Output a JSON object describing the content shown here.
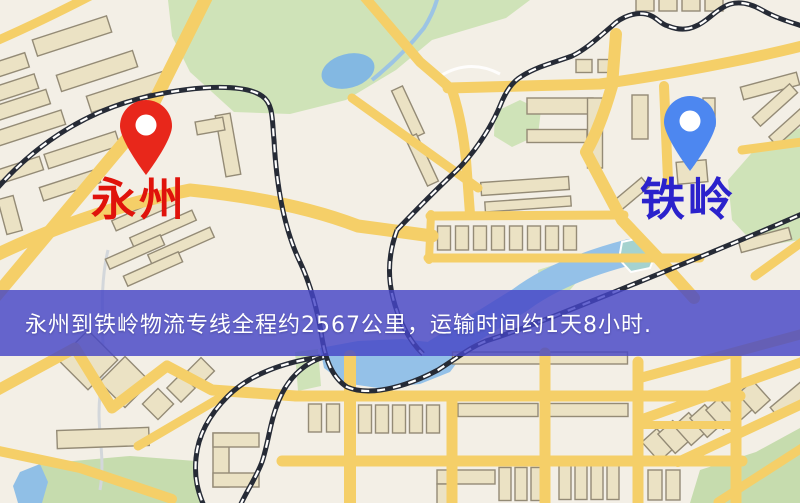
{
  "map": {
    "markers": {
      "origin": {
        "label": "永州",
        "pin_color": "#e8271b",
        "label_color": "#e0130b"
      },
      "destination": {
        "label": "铁岭",
        "pin_color": "#4d87f0",
        "label_color": "#2b22cc"
      }
    },
    "banner": {
      "text": "永州到铁岭物流专线全程约2567公里，运输时间约1天8小时.",
      "background_color": "#4646c6",
      "text_color": "#ffffff"
    },
    "palette": {
      "map_background": "#f3efe6",
      "road_yellow": "#f5cf68",
      "park_green": "#cfe3b8",
      "water_blue": "#90bfe6",
      "building_tan": "#ebe2c4",
      "railway_dark": "#262b36"
    }
  }
}
